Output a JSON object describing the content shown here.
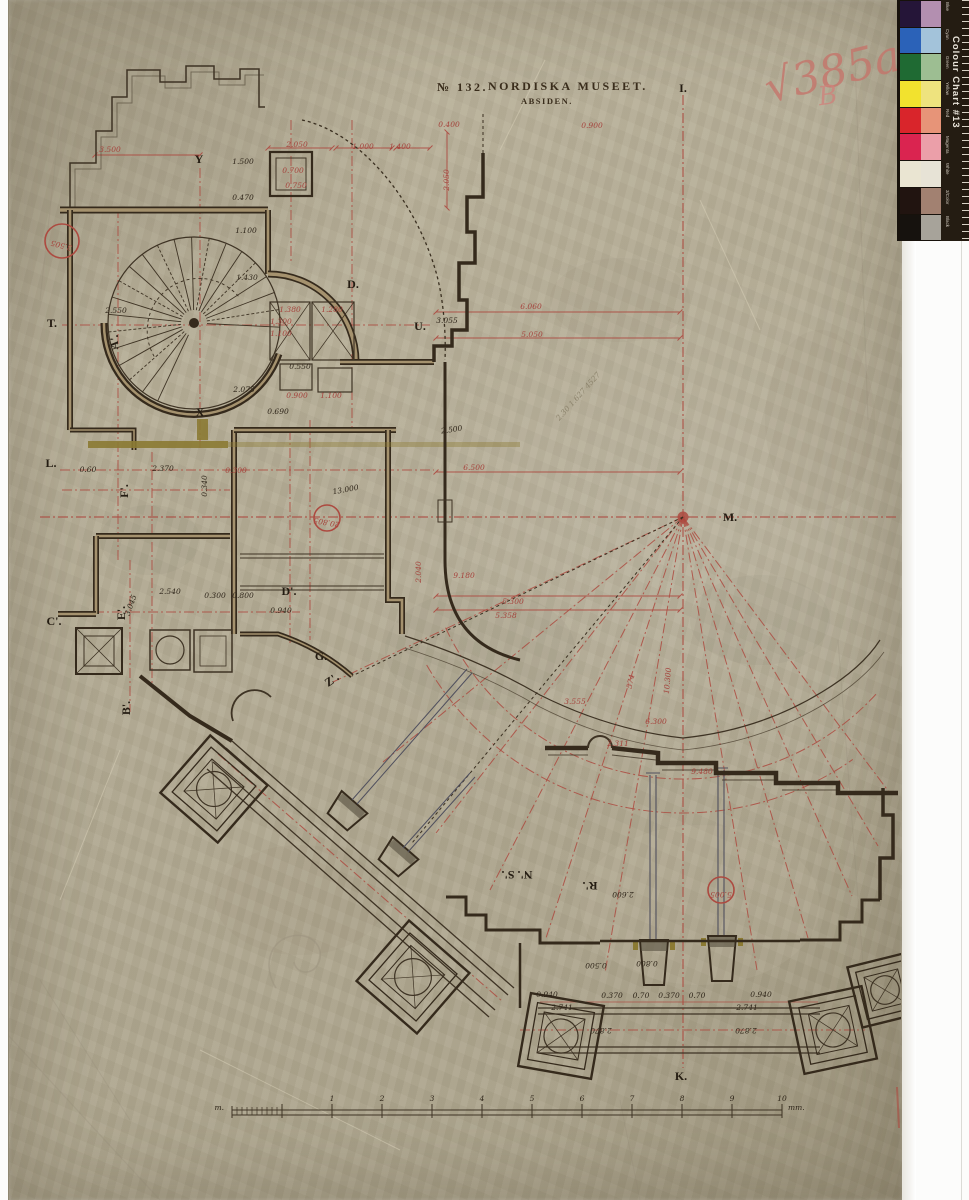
{
  "document": {
    "archive_no": "№ 132.",
    "title": "Nordiska Museet.",
    "subtitle": "Absiden.",
    "collection_mark": "√385a",
    "collection_mark_2": "B"
  },
  "color_chart": {
    "label": "Colour Chart #13",
    "rows": [
      {
        "name": "Blue",
        "solid": "#251538",
        "tint": "#b38fb0"
      },
      {
        "name": "Cyan",
        "solid": "#2b62b8",
        "tint": "#a3c3da"
      },
      {
        "name": "Green",
        "solid": "#1f6a33",
        "tint": "#9dbe92"
      },
      {
        "name": "Yellow",
        "solid": "#f2e22e",
        "tint": "#eee37e"
      },
      {
        "name": "Red",
        "solid": "#d9252b",
        "tint": "#e79478"
      },
      {
        "name": "Magenta",
        "solid": "#da2450",
        "tint": "#eb9fa9"
      },
      {
        "name": "White",
        "solid": "#eae5d2",
        "tint": "#e7e3d6"
      },
      {
        "name": "3/Color",
        "solid": "#211410",
        "tint": "#a28171"
      },
      {
        "name": "Black",
        "solid": "#16120e",
        "tint": "#a7a39a"
      }
    ]
  },
  "scale_bar": {
    "left_label": "m.",
    "right_label": "mm.",
    "ticks": [
      "1",
      "2",
      "3",
      "4",
      "5",
      "6",
      "7",
      "8",
      "9",
      "10"
    ]
  },
  "plan": {
    "letters": [
      {
        "t": "I.",
        "x": 683,
        "y": 92
      },
      {
        "t": "Y",
        "x": 199,
        "y": 163
      },
      {
        "t": "X",
        "x": 200,
        "y": 416
      },
      {
        "t": "T.",
        "x": 52,
        "y": 327
      },
      {
        "t": "A'.",
        "x": 118,
        "y": 342,
        "r": -90
      },
      {
        "t": "D.",
        "x": 353,
        "y": 288
      },
      {
        "t": "U.",
        "x": 420,
        "y": 330
      },
      {
        "t": "L.",
        "x": 51,
        "y": 467
      },
      {
        "t": "F'.",
        "x": 128,
        "y": 491,
        "r": -90
      },
      {
        "t": "E'.",
        "x": 125,
        "y": 613,
        "r": -90
      },
      {
        "t": "C'.",
        "x": 54,
        "y": 625
      },
      {
        "t": "B'.",
        "x": 130,
        "y": 708,
        "r": -90
      },
      {
        "t": "D'.",
        "x": 289,
        "y": 595
      },
      {
        "t": "G.",
        "x": 321,
        "y": 660
      },
      {
        "t": "Z'.",
        "x": 334,
        "y": 683,
        "r": -35
      },
      {
        "t": "M.",
        "x": 730,
        "y": 521
      },
      {
        "t": "N'. S'.",
        "x": 517,
        "y": 871,
        "r": 180
      },
      {
        "t": "R'.",
        "x": 590,
        "y": 882,
        "r": 180
      },
      {
        "t": "K.",
        "x": 681,
        "y": 1080
      }
    ],
    "dims": [
      {
        "t": "3.500",
        "x": 110,
        "y": 152
      },
      {
        "t": "1.500",
        "x": 243,
        "y": 164,
        "c": "k"
      },
      {
        "t": "2.050",
        "x": 297,
        "y": 147
      },
      {
        "t": "1.000",
        "x": 363,
        "y": 149
      },
      {
        "t": "1.400",
        "x": 400,
        "y": 149
      },
      {
        "t": "0.400",
        "x": 449,
        "y": 127
      },
      {
        "t": "0.900",
        "x": 592,
        "y": 128
      },
      {
        "t": "2.050",
        "x": 449,
        "y": 180,
        "r": -90
      },
      {
        "t": "0.700",
        "x": 293,
        "y": 173
      },
      {
        "t": "0.750",
        "x": 296,
        "y": 188
      },
      {
        "t": "0.470",
        "x": 243,
        "y": 200,
        "c": "k"
      },
      {
        "t": "1.100",
        "x": 246,
        "y": 233,
        "c": "k"
      },
      {
        "t": "1.430",
        "x": 247,
        "y": 280,
        "c": "k"
      },
      {
        "t": "2.550",
        "x": 116,
        "y": 313,
        "c": "k"
      },
      {
        "t": "1.380",
        "x": 290,
        "y": 312
      },
      {
        "t": "1.280",
        "x": 332,
        "y": 312
      },
      {
        "t": "1.300",
        "x": 281,
        "y": 324
      },
      {
        "t": "1.100",
        "x": 281,
        "y": 336
      },
      {
        "t": "3.055",
        "x": 447,
        "y": 323,
        "c": "k"
      },
      {
        "t": "6.060",
        "x": 531,
        "y": 309
      },
      {
        "t": "5.050",
        "x": 532,
        "y": 337
      },
      {
        "t": "0.550",
        "x": 300,
        "y": 369,
        "c": "k"
      },
      {
        "t": "2.075",
        "x": 244,
        "y": 392,
        "c": "k"
      },
      {
        "t": "0.900",
        "x": 297,
        "y": 398
      },
      {
        "t": "1.100",
        "x": 331,
        "y": 398
      },
      {
        "t": "0.690",
        "x": 278,
        "y": 414,
        "c": "k"
      },
      {
        "t": "2.500",
        "x": 452,
        "y": 432,
        "c": "k",
        "r": -8
      },
      {
        "t": "6.500",
        "x": 474,
        "y": 470
      },
      {
        "t": "0.60",
        "x": 88,
        "y": 472,
        "c": "k"
      },
      {
        "t": "2.370",
        "x": 163,
        "y": 471,
        "c": "k"
      },
      {
        "t": "0.300",
        "x": 236,
        "y": 473
      },
      {
        "t": "0.340",
        "x": 207,
        "y": 486,
        "r": -90,
        "c": "k"
      },
      {
        "t": "13.000",
        "x": 346,
        "y": 492,
        "c": "k",
        "r": -10,
        "s": 11
      },
      {
        "t": "2.540",
        "x": 170,
        "y": 594,
        "c": "k"
      },
      {
        "t": "3.045",
        "x": 133,
        "y": 606,
        "c": "k",
        "r": -70
      },
      {
        "t": "0.300",
        "x": 215,
        "y": 598,
        "c": "k"
      },
      {
        "t": "0.800",
        "x": 243,
        "y": 598,
        "c": "k"
      },
      {
        "t": "0.940",
        "x": 281,
        "y": 613,
        "c": "k"
      },
      {
        "t": "9.180",
        "x": 464,
        "y": 578
      },
      {
        "t": "2.040",
        "x": 421,
        "y": 572,
        "r": -90
      },
      {
        "t": "5.300",
        "x": 513,
        "y": 604
      },
      {
        "t": "5.358",
        "x": 506,
        "y": 618
      },
      {
        "t": "3.555",
        "x": 575,
        "y": 704
      },
      {
        "t": "574",
        "x": 633,
        "y": 682,
        "r": -78
      },
      {
        "t": "10.300",
        "x": 670,
        "y": 681,
        "r": -85
      },
      {
        "t": "6.300",
        "x": 656,
        "y": 724
      },
      {
        "t": "2.311",
        "x": 618,
        "y": 746
      },
      {
        "t": "9.480",
        "x": 702,
        "y": 774
      },
      {
        "t": "2.600",
        "x": 623,
        "y": 892,
        "r": 180,
        "c": "k"
      },
      {
        "t": "0.500",
        "x": 596,
        "y": 963,
        "r": 180,
        "c": "k"
      },
      {
        "t": "0.800",
        "x": 647,
        "y": 961,
        "r": 180,
        "c": "k"
      },
      {
        "t": "0.940",
        "x": 547,
        "y": 997,
        "c": "k"
      },
      {
        "t": "0.370",
        "x": 612,
        "y": 998,
        "c": "k"
      },
      {
        "t": "0.70",
        "x": 641,
        "y": 998,
        "c": "k"
      },
      {
        "t": "0.370",
        "x": 669,
        "y": 998,
        "c": "k"
      },
      {
        "t": "0.70",
        "x": 697,
        "y": 998,
        "c": "k"
      },
      {
        "t": "0.940",
        "x": 761,
        "y": 997,
        "c": "k"
      },
      {
        "t": "2.741",
        "x": 562,
        "y": 1010,
        "c": "k"
      },
      {
        "t": "2.741",
        "x": 747,
        "y": 1010,
        "c": "k"
      },
      {
        "t": "2.870",
        "x": 601,
        "y": 1028,
        "r": 180,
        "c": "k"
      },
      {
        "t": "2.870",
        "x": 746,
        "y": 1028,
        "r": 180,
        "c": "k"
      },
      {
        "t": "2.30 1.627 4527",
        "x": 580,
        "y": 398,
        "r": -48,
        "c": "p"
      }
    ],
    "circled": [
      {
        "t": "3.505",
        "x": 62,
        "y": 241,
        "rad": 17,
        "r": 195
      },
      {
        "t": "20.805",
        "x": 327,
        "y": 518,
        "rad": 13,
        "r": 190
      },
      {
        "t": "5.005",
        "x": 721,
        "y": 890,
        "rad": 13,
        "r": 180
      }
    ]
  }
}
